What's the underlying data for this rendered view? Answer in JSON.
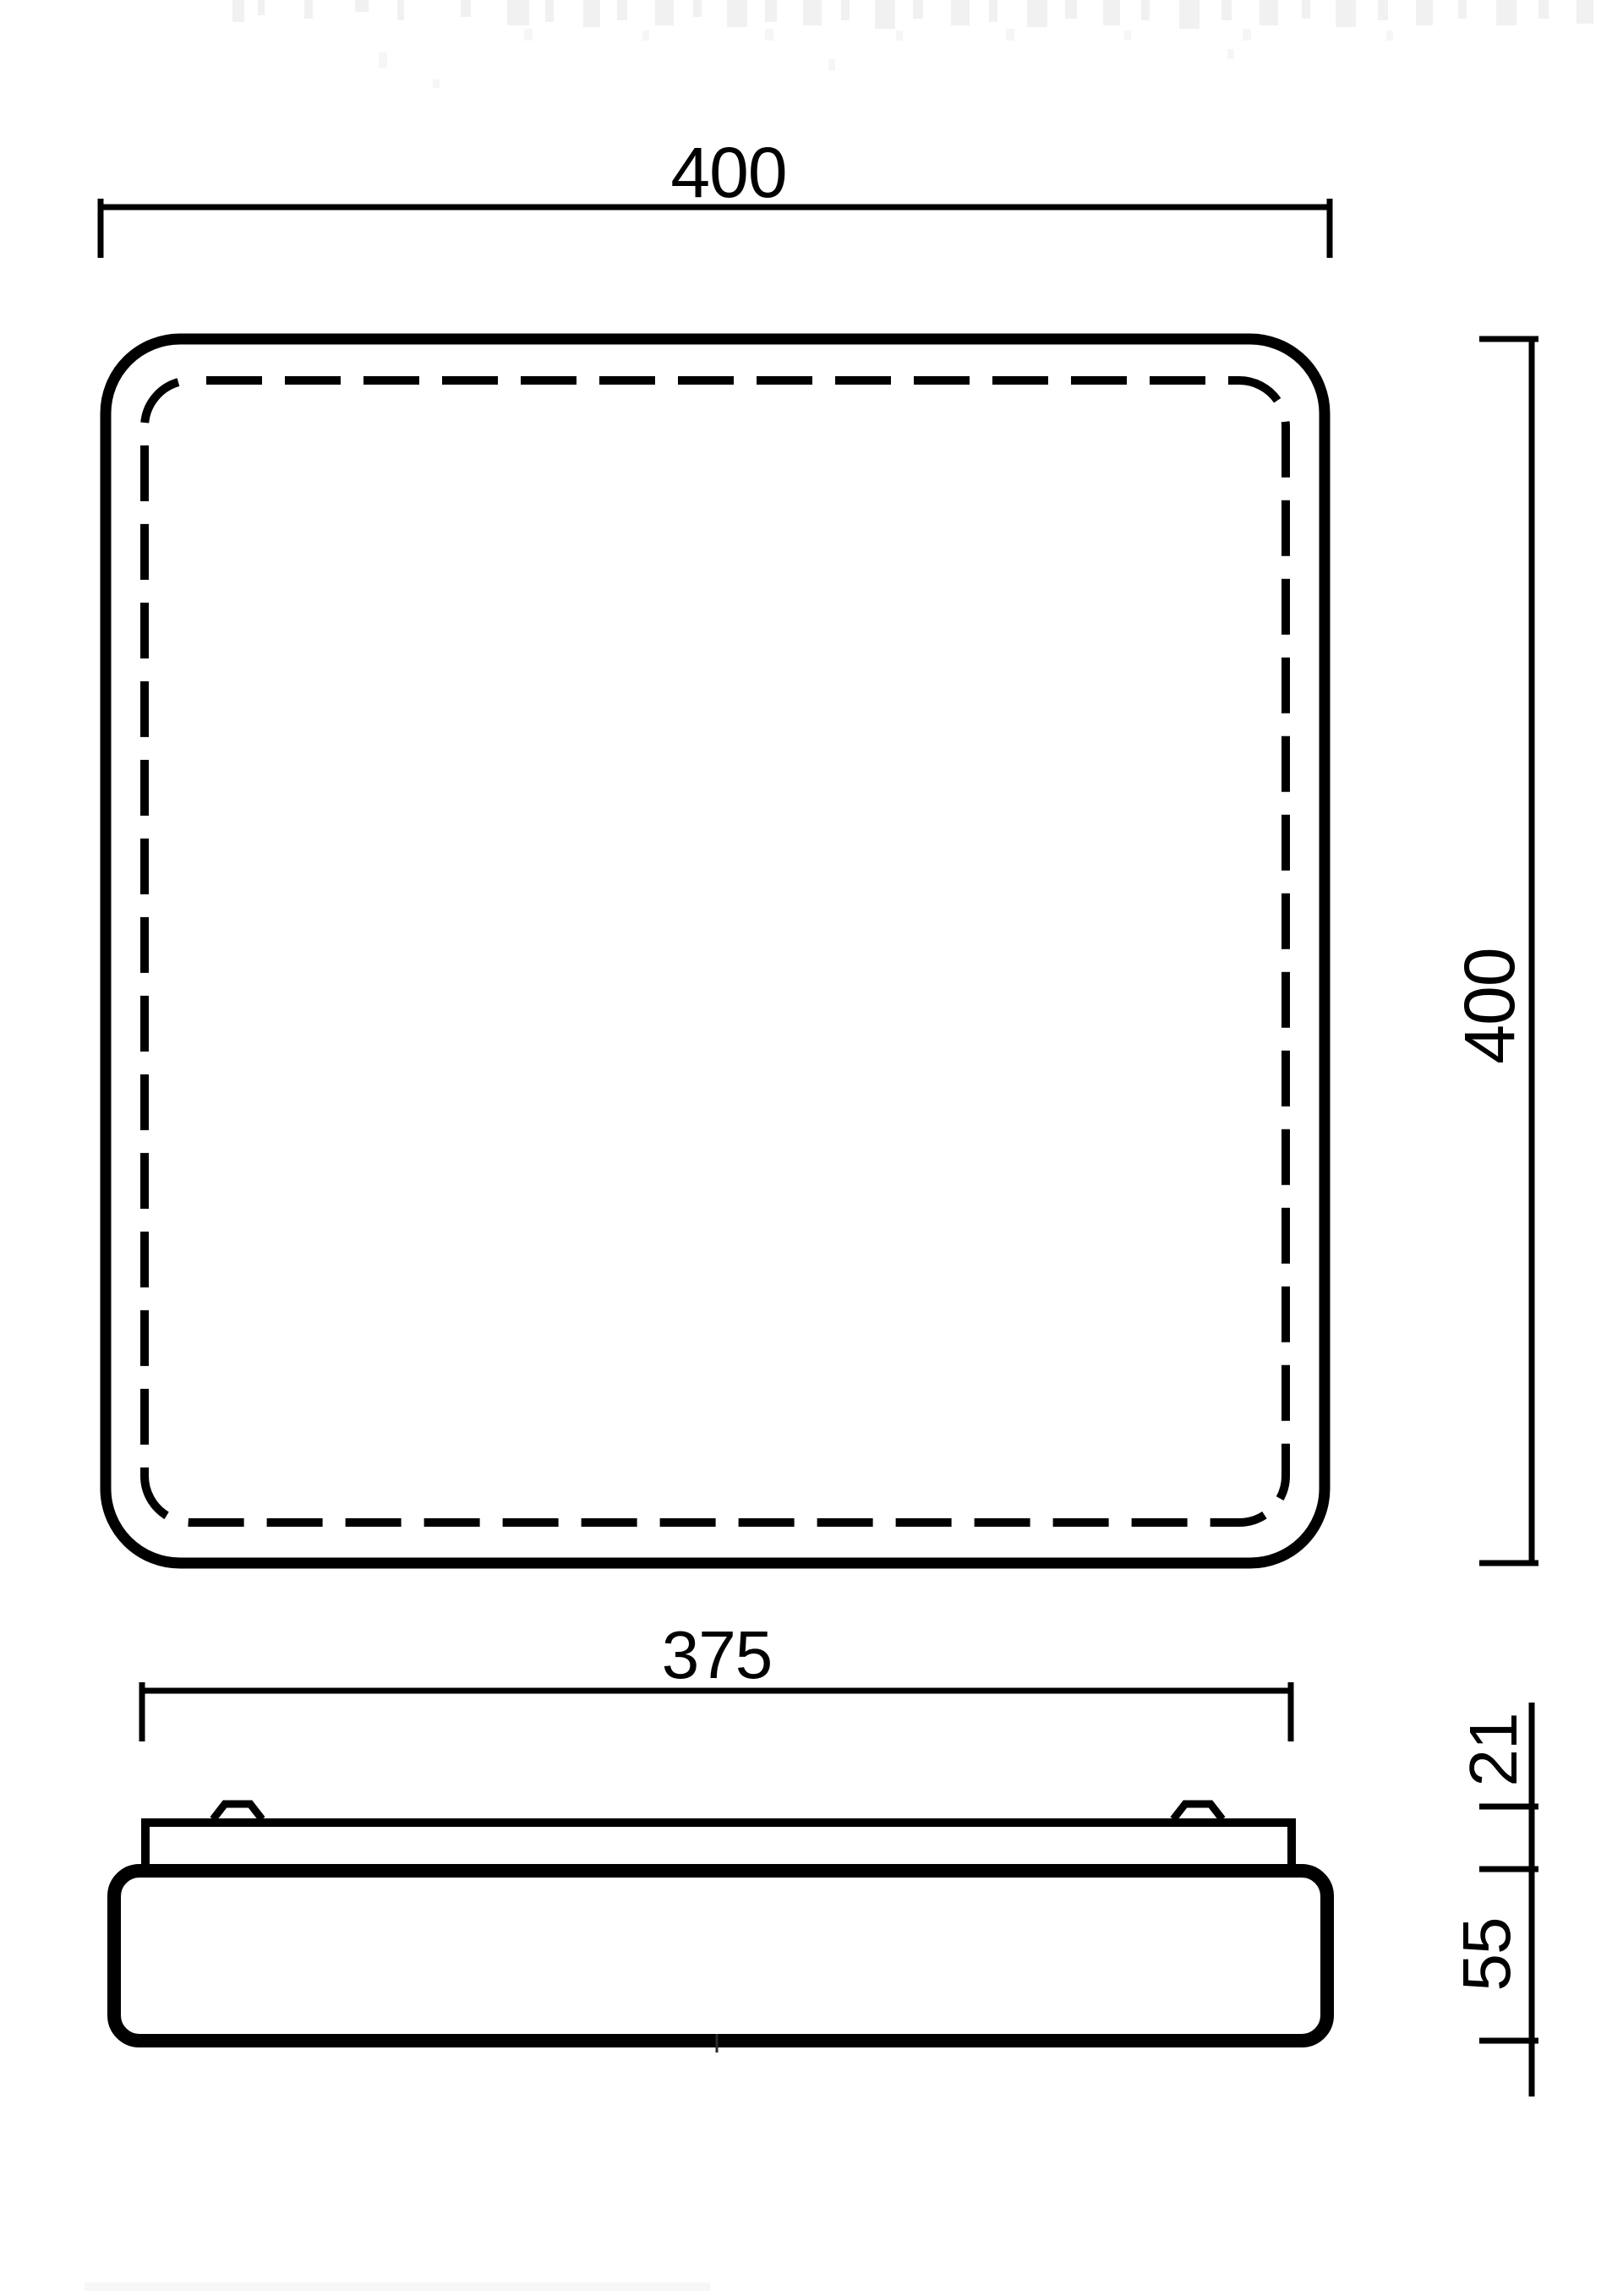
{
  "drawing": {
    "type": "technical-dimension-drawing",
    "subject": "square ceiling luminaire, top view and side view",
    "line_color": "#000000",
    "background_color": "#ffffff",
    "dims": {
      "overall_width": {
        "value": "400",
        "orientation": "horizontal",
        "applies_to": "top view overall width"
      },
      "overall_height": {
        "value": "400",
        "orientation": "vertical",
        "applies_to": "top view overall height"
      },
      "backplate_width": {
        "value": "375",
        "orientation": "horizontal",
        "applies_to": "side view base plate width"
      },
      "backplate_height": {
        "value": "21",
        "orientation": "vertical",
        "applies_to": "side view base plate + clip height"
      },
      "body_height": {
        "value": "55",
        "orientation": "vertical",
        "applies_to": "side view diffuser body height"
      }
    }
  }
}
